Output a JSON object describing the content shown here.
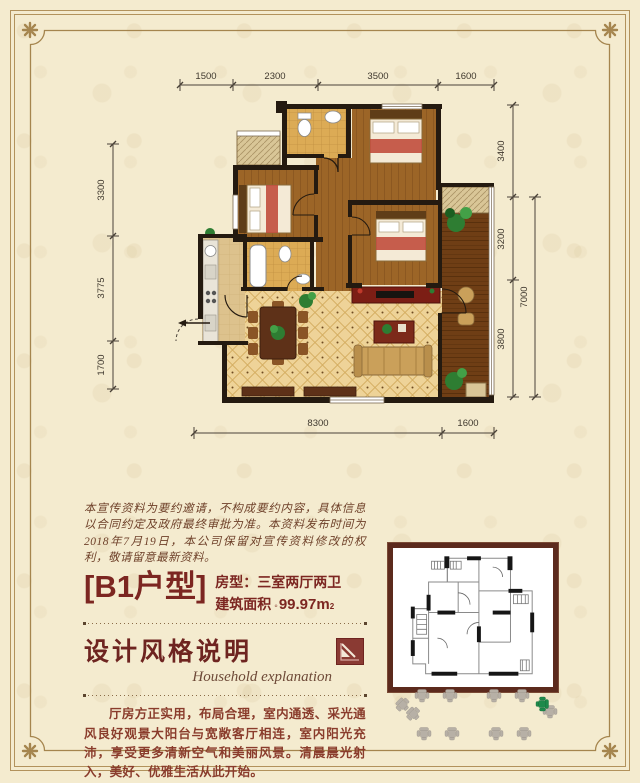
{
  "poster": {
    "bg_color": "#f4ebcf",
    "frame_color": "#a5854e",
    "accent_color": "#7c2621"
  },
  "plan": {
    "dims_top": [
      "1500",
      "2300",
      "3500",
      "1600"
    ],
    "dims_left": [
      "3300",
      "3775",
      "1700"
    ],
    "dims_right": [
      "3400",
      "3200",
      "3800"
    ],
    "dim_right_total": "7000",
    "dims_bottom": [
      "8300",
      "1600"
    ]
  },
  "disclaimer": {
    "text": "本宣传资料为要约邀请，不构成要约内容，具体信息以合同约定及政府最终审批为准。本资料发布时间为2018年7月19日，本公司保留对宣传资料修改的权利，敬请留意最新资料。"
  },
  "unit": {
    "title": "[B1户型]",
    "room_type": "房型：三室两厅两卫",
    "area_label": "建筑面积",
    "area_sep": "◦",
    "area_value": "99.97m",
    "area_sup": "2"
  },
  "section": {
    "heading": "设计风格说明",
    "subheading": "Household explanation",
    "body": "厅房方正实用，布局合理，室内通透、采光通风良好观景大阳台与宽敞客厅相连，室内阳光充沛，享受更多清新空气和美丽风景。清晨晨光射入，美好、优雅生活从此开始。",
    "icon": "corner-arrow-icon"
  },
  "inset": {
    "description": "b1-unit-outline-schematic"
  },
  "watermark": {
    "icons": "chair-icons",
    "chair_color": "#b7b0a6",
    "green_chair_color": "#1e8a4b"
  }
}
